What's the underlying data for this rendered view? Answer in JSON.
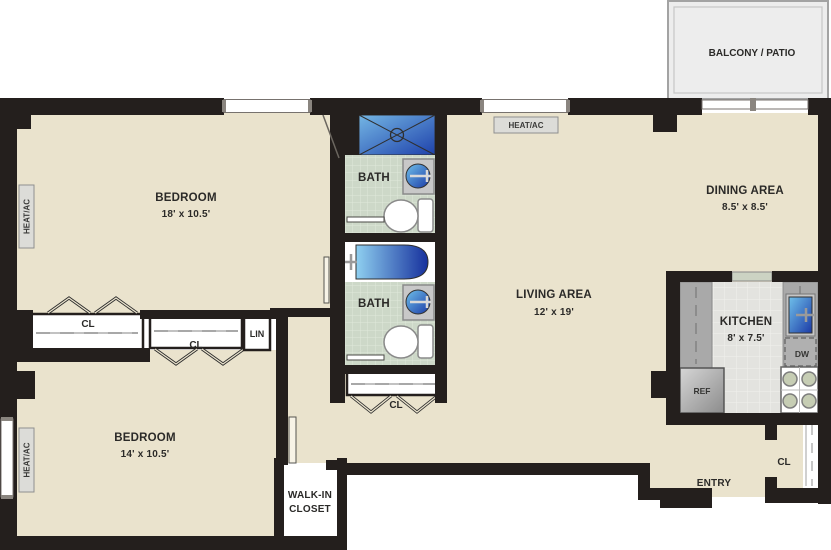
{
  "balcony": {
    "label": "BALCONY / PATIO"
  },
  "rooms": {
    "bedroom1": {
      "name": "BEDROOM",
      "dims": "18' x 10.5'"
    },
    "bedroom2": {
      "name": "BEDROOM",
      "dims": "14' x 10.5'"
    },
    "living": {
      "name": "LIVING AREA",
      "dims": "12' x 19'"
    },
    "dining": {
      "name": "DINING AREA",
      "dims": "8.5' x 8.5'"
    },
    "kitchen": {
      "name": "KITCHEN",
      "dims": "8' x 7.5'"
    },
    "bath_upper": {
      "name": "BATH"
    },
    "bath_lower": {
      "name": "BATH"
    },
    "walk_in_closet": {
      "line1": "WALK-IN",
      "line2": "CLOSET"
    },
    "entry": {
      "name": "ENTRY"
    }
  },
  "labels": {
    "heat_ac": "HEAT/AC",
    "closet": "CL",
    "linen": "LIN",
    "refrigerator": "REF",
    "dishwasher": "DW"
  },
  "colors": {
    "wall": "#241f1d",
    "floor": "#eae3cd",
    "bath_tile": "#cdd8c8",
    "kitchen_floor": "#e3e3df",
    "counter": "#a9a9a9",
    "fixture_blue_dark": "#1b3aa6",
    "fixture_blue_light": "#86cdf0",
    "balcony_fill": "#ededed"
  }
}
